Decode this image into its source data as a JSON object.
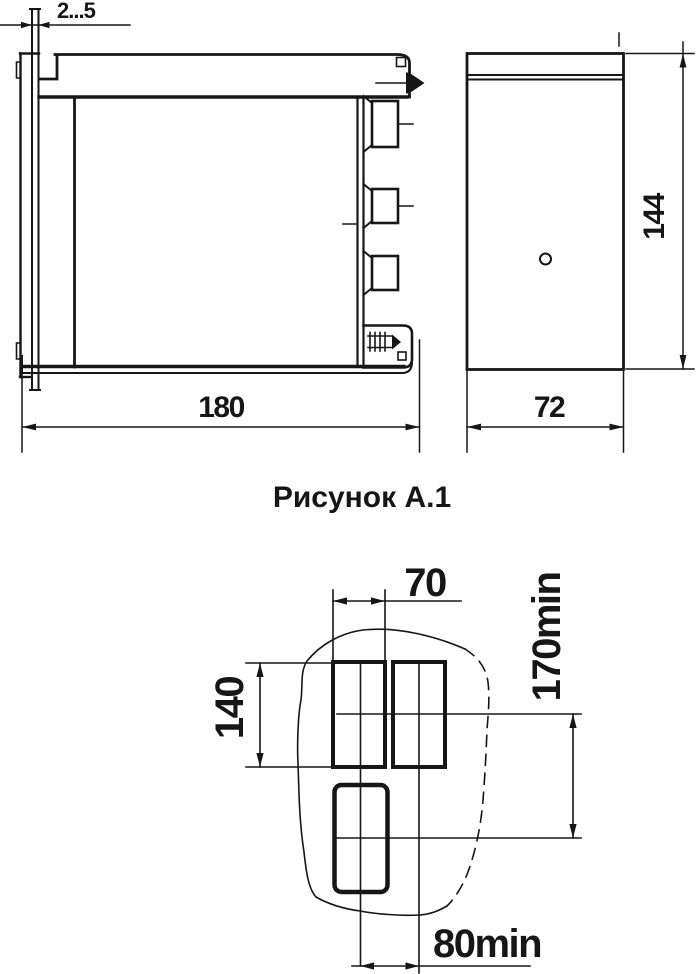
{
  "figure_a1": {
    "caption": "Рисунок А.1",
    "side_view": {
      "panel_thickness": "2...5",
      "depth": "180"
    },
    "rear_view": {
      "width": "72",
      "height": "144"
    },
    "panel_cutout": {
      "cutout_width": "70",
      "cutout_height": "140",
      "row_spacing_min": "170min",
      "column_spacing_min": "80min"
    }
  }
}
